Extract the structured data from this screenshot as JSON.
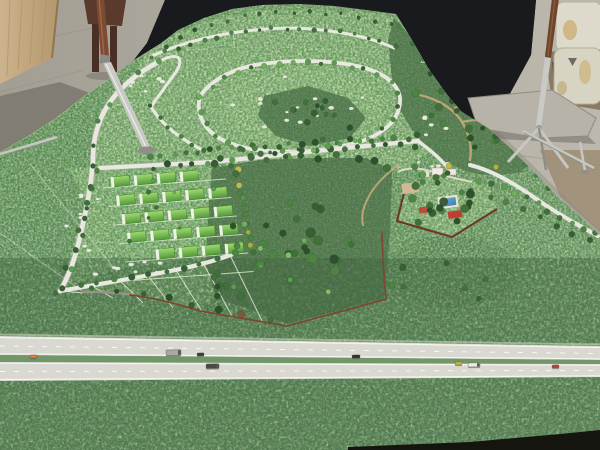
{
  "scene": {
    "subject": "Photograph of a green landscape-architecture scale model in a workshop: terrain with looping roads lined by miniature trees, a block of greenhouses, a dark central forest bounded by a thin fence, a villa compound with blue swimming pool and red roofs, and a dual-carriageway highway with tiny vehicles across the foreground; concrete floor, black backdrop, plywood sheet, stacked sacks and metal tripod stands behind the model",
    "colors": {
      "floor": "#aba79c",
      "floorShadow": "#7e7a70",
      "plywood": "#c7ae87",
      "backdrop": "#191a1d",
      "modelLight": "#a6c98c",
      "modelBase": "#7ea472",
      "forest": "#44693a",
      "road": "#e8e8e0",
      "dirtPath": "#c6a87c",
      "fence": "#7a4830",
      "wall": "#6e3626",
      "highway": "#d9d9d1",
      "median": "#70966a",
      "pool": "#4a8fc0",
      "roof": "#bc3f31",
      "lawn": "#a9cb8f",
      "greenhouseRoof": "#74bd4a",
      "sack": "#dcd8ca",
      "metal": "#c7c7c1",
      "wood": "#7d4a32"
    },
    "tree_palette": [
      "#2c512c",
      "#375f33",
      "#41713a",
      "#4c8443",
      "#5c9c4e",
      "#6fae5b",
      "#82be6a",
      "#a4b23c",
      "#c3b94a",
      "#7a5a3a"
    ],
    "tree_lines": [
      {
        "name": "avenue-north-trees",
        "pts": [
          [
            150,
            157
          ],
          [
            212,
            151
          ],
          [
            280,
            145
          ],
          [
            350,
            140
          ],
          [
            418,
            137
          ]
        ],
        "n": 24,
        "jit": 2.5,
        "rmin": 2,
        "rmax": 3.4,
        "pal": [
          0,
          1,
          2,
          3,
          4
        ]
      },
      {
        "name": "avenue-south-trees",
        "pts": [
          [
            152,
            167
          ],
          [
            214,
            161
          ],
          [
            282,
            154
          ],
          [
            352,
            148
          ],
          [
            414,
            145
          ]
        ],
        "n": 20,
        "jit": 2.5,
        "rmin": 2,
        "rmax": 3.4,
        "pal": [
          0,
          1,
          2,
          4
        ]
      },
      {
        "name": "loop-road-trees",
        "pts": [
          [
            200,
            96
          ],
          [
            226,
            76
          ],
          [
            268,
            64
          ],
          [
            318,
            62
          ],
          [
            362,
            68
          ],
          [
            393,
            82
          ],
          [
            400,
            100
          ],
          [
            394,
            120
          ],
          [
            368,
            138
          ],
          [
            328,
            148
          ],
          [
            284,
            152
          ],
          [
            244,
            148
          ],
          [
            216,
            136
          ],
          [
            202,
            118
          ],
          [
            200,
            96
          ]
        ],
        "n": 34,
        "jit": 2,
        "rmin": 1.8,
        "rmax": 3,
        "pal": [
          1,
          2,
          3,
          4,
          5
        ]
      },
      {
        "name": "top-road-trees",
        "pts": [
          [
            152,
            56
          ],
          [
            200,
            40
          ],
          [
            256,
            30
          ],
          [
            310,
            28
          ],
          [
            360,
            34
          ],
          [
            394,
            46
          ]
        ],
        "n": 19,
        "jit": 2,
        "rmin": 1.6,
        "rmax": 2.6,
        "pal": [
          1,
          2,
          3
        ]
      },
      {
        "name": "west-road-trees",
        "pts": [
          [
            158,
            64
          ],
          [
            128,
            80
          ],
          [
            108,
            102
          ],
          [
            97,
            130
          ],
          [
            93,
            160
          ],
          [
            86,
            198
          ],
          [
            78,
            236
          ],
          [
            64,
            274
          ],
          [
            58,
            290
          ]
        ],
        "n": 13,
        "jit": 3,
        "rmin": 1.8,
        "rmax": 3,
        "pal": [
          1,
          2,
          3,
          4
        ]
      },
      {
        "name": "greenhouse-left-trees",
        "pts": [
          [
            97,
            170
          ],
          [
            88,
            204
          ],
          [
            81,
            238
          ],
          [
            70,
            268
          ]
        ],
        "n": 7,
        "jit": 2,
        "rmin": 2,
        "rmax": 3.2,
        "pal": [
          1,
          2,
          3,
          4
        ]
      },
      {
        "name": "greenhouse-bottom-trees",
        "pts": [
          [
            64,
            288
          ],
          [
            112,
            280
          ],
          [
            162,
            272
          ],
          [
            212,
            260
          ],
          [
            234,
            252
          ]
        ],
        "n": 11,
        "jit": 2,
        "rmin": 2.2,
        "rmax": 3.4,
        "pal": [
          0,
          1,
          2,
          3
        ]
      },
      {
        "name": "greenhouse-right-trees",
        "pts": [
          [
            236,
            168
          ],
          [
            242,
            198
          ],
          [
            247,
            228
          ],
          [
            251,
            254
          ]
        ],
        "n": 12,
        "jit": 2.5,
        "rmin": 2,
        "rmax": 3.4,
        "pal": [
          2,
          3,
          4,
          7,
          8,
          3
        ]
      },
      {
        "name": "east-road-north-trees",
        "pts": [
          [
            478,
            180
          ],
          [
            508,
            190
          ],
          [
            538,
            205
          ],
          [
            568,
            221
          ],
          [
            595,
            233
          ]
        ],
        "n": 11,
        "jit": 2,
        "rmin": 2.2,
        "rmax": 3.6,
        "pal": [
          2,
          3,
          4,
          5
        ]
      },
      {
        "name": "east-road-south-trees",
        "pts": [
          [
            472,
            190
          ],
          [
            503,
            200
          ],
          [
            533,
            215
          ],
          [
            562,
            230
          ],
          [
            588,
            241
          ]
        ],
        "n": 8,
        "jit": 2,
        "rmin": 2,
        "rmax": 3,
        "pal": [
          1,
          2,
          3
        ]
      },
      {
        "name": "hairpin-road-trees",
        "pts": [
          [
            150,
            106
          ],
          [
            166,
            126
          ],
          [
            188,
            142
          ],
          [
            204,
            150
          ]
        ],
        "n": 6,
        "jit": 2,
        "rmin": 1.8,
        "rmax": 2.8,
        "pal": [
          1,
          2,
          3
        ]
      },
      {
        "name": "fence-line-trees",
        "pts": [
          [
            92,
            290
          ],
          [
            136,
            294
          ],
          [
            182,
            302
          ],
          [
            228,
            312
          ],
          [
            268,
            320
          ]
        ],
        "n": 8,
        "jit": 3,
        "rmin": 2.4,
        "rmax": 4,
        "pal": [
          0,
          1,
          2,
          9
        ]
      },
      {
        "name": "ridge-silhouette-trees",
        "pts": [
          [
            166,
            46
          ],
          [
            208,
            26
          ],
          [
            258,
            13
          ],
          [
            314,
            11
          ],
          [
            362,
            17
          ],
          [
            392,
            23
          ]
        ],
        "n": 15,
        "jit": 2,
        "rmin": 1.4,
        "rmax": 2.3,
        "pal": [
          0,
          1,
          2
        ]
      },
      {
        "name": "forest-north-edge-trees",
        "pts": [
          [
            216,
            166
          ],
          [
            262,
            158
          ],
          [
            312,
            156
          ],
          [
            362,
            157
          ],
          [
            390,
            166
          ]
        ],
        "n": 11,
        "jit": 3,
        "rmin": 2.5,
        "rmax": 4,
        "pal": [
          0,
          1,
          2
        ]
      },
      {
        "name": "northeast-edge-trees",
        "pts": [
          [
            400,
            28
          ],
          [
            418,
            52
          ],
          [
            436,
            80
          ],
          [
            454,
            104
          ],
          [
            478,
            118
          ],
          [
            502,
            140
          ],
          [
            526,
            164
          ],
          [
            550,
            190
          ]
        ],
        "n": 13,
        "jit": 3,
        "rmin": 2,
        "rmax": 3.2,
        "pal": [
          0,
          1,
          2,
          3
        ]
      }
    ],
    "tree_clusters": [
      {
        "name": "central-forest-trees",
        "cx": 298,
        "cy": 235,
        "rx": 85,
        "ry": 66,
        "n": 26,
        "rmin": 2.5,
        "rmax": 5,
        "pal": [
          0,
          1,
          2,
          3
        ]
      },
      {
        "name": "central-forest-accents",
        "cx": 300,
        "cy": 250,
        "rx": 80,
        "ry": 60,
        "n": 8,
        "rmin": 2,
        "rmax": 3.2,
        "pal": [
          4,
          5,
          6
        ]
      },
      {
        "name": "northeast-forest-trees",
        "cx": 462,
        "cy": 118,
        "rx": 52,
        "ry": 44,
        "n": 18,
        "rmin": 2.2,
        "rmax": 4,
        "pal": [
          0,
          1,
          2,
          3
        ]
      },
      {
        "name": "north-patch-trees",
        "cx": 312,
        "cy": 114,
        "rx": 44,
        "ry": 24,
        "n": 12,
        "rmin": 2,
        "rmax": 3.6,
        "pal": [
          0,
          1,
          2
        ]
      },
      {
        "name": "compound-trees",
        "cx": 446,
        "cy": 206,
        "rx": 40,
        "ry": 26,
        "n": 16,
        "rmin": 2.6,
        "rmax": 4.4,
        "pal": [
          0,
          1,
          2,
          3
        ]
      },
      {
        "name": "compound-entry-trees",
        "cx": 428,
        "cy": 176,
        "rx": 26,
        "ry": 12,
        "n": 7,
        "rmin": 2,
        "rmax": 3.4,
        "pal": [
          1,
          2,
          3,
          4
        ]
      },
      {
        "name": "slope-scatter-trees",
        "cx": 430,
        "cy": 284,
        "rx": 58,
        "ry": 28,
        "n": 7,
        "rmin": 2,
        "rmax": 3.4,
        "pal": [
          1,
          2,
          3
        ]
      },
      {
        "name": "greenhouse-inner-trees",
        "cx": 168,
        "cy": 212,
        "rx": 52,
        "ry": 38,
        "n": 11,
        "rmin": 1.4,
        "rmax": 2.4,
        "pal": [
          2,
          3,
          4,
          5
        ]
      },
      {
        "name": "forest-west-trees",
        "cx": 216,
        "cy": 286,
        "rx": 24,
        "ry": 26,
        "n": 8,
        "rmin": 2.2,
        "rmax": 3.6,
        "pal": [
          0,
          1,
          2
        ]
      }
    ],
    "dot_clusters": [
      {
        "name": "loop-plot-dots",
        "cx": 300,
        "cy": 106,
        "rx": 78,
        "ry": 36,
        "n": 16
      },
      {
        "name": "left-strip-dots",
        "cx": 82,
        "cy": 225,
        "rx": 20,
        "ry": 46,
        "n": 9
      },
      {
        "name": "fan-dots",
        "cx": 132,
        "cy": 268,
        "rx": 52,
        "ry": 13,
        "n": 8
      },
      {
        "name": "upperleft-dots",
        "cx": 152,
        "cy": 82,
        "rx": 28,
        "ry": 22,
        "n": 6
      },
      {
        "name": "east-dots",
        "cx": 428,
        "cy": 122,
        "rx": 22,
        "ry": 26,
        "n": 5
      },
      {
        "name": "compound-north-dots",
        "cx": 432,
        "cy": 166,
        "rx": 20,
        "ry": 7,
        "n": 4
      }
    ],
    "greenhouse_grid": {
      "x0": 113,
      "y0": 177,
      "rows": 5,
      "cols": 5,
      "colDx": 23,
      "colDy": -1.8,
      "rowDx": 5.5,
      "rowDy": 18.5,
      "w": 16,
      "h": 10,
      "angle": -6,
      "skip": [
        [
          0,
          4
        ],
        [
          4,
          0
        ]
      ]
    },
    "vehicles": [
      {
        "name": "orange-car",
        "x": 30,
        "y": 355,
        "w": 7,
        "h": 3.2,
        "color": "#d9822b"
      },
      {
        "name": "grey-truck",
        "x": 166,
        "y": 350,
        "w": 15,
        "h": 5.5,
        "color": "#a9a9a1"
      },
      {
        "name": "dark-car",
        "x": 197,
        "y": 353,
        "w": 7,
        "h": 3,
        "color": "#3c3c38"
      },
      {
        "name": "dark-van",
        "x": 206,
        "y": 364,
        "w": 13,
        "h": 4.5,
        "color": "#4a4a42"
      },
      {
        "name": "black-car",
        "x": 352,
        "y": 355,
        "w": 8,
        "h": 3.2,
        "color": "#32322e"
      },
      {
        "name": "yellow-car",
        "x": 455,
        "y": 362,
        "w": 7,
        "h": 3,
        "color": "#c9b93c"
      },
      {
        "name": "white-van",
        "x": 468,
        "y": 363,
        "w": 12,
        "h": 4,
        "color": "#ecece6"
      },
      {
        "name": "red-car",
        "x": 552,
        "y": 365,
        "w": 7,
        "h": 3,
        "color": "#bf4034"
      }
    ]
  }
}
